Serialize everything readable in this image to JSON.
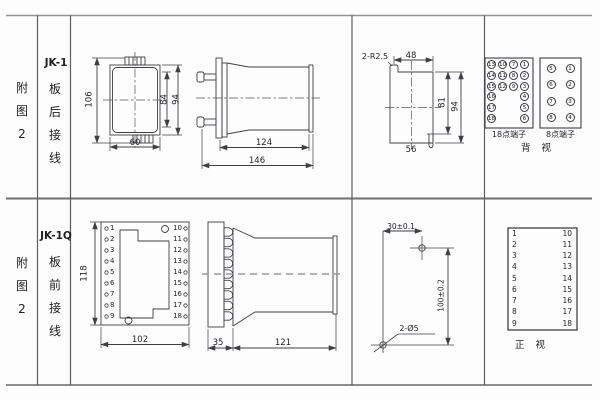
{
  "top": {
    "fig_label": {
      "c1": "附",
      "c2": "图",
      "c3": "2"
    },
    "model": "JK-1",
    "wiring": {
      "c1": "板",
      "c2": "后",
      "c3": "接",
      "c4": "线"
    },
    "rear_dims": {
      "d106": "106",
      "d84": "84",
      "d94": "94",
      "d60": "60"
    },
    "side_dims": {
      "d124": "124",
      "d146": "146"
    },
    "cutout_dims": {
      "radius": "2-R2.5",
      "d48": "48",
      "d81": "81",
      "d94": "94",
      "d56": "56"
    },
    "t18": {
      "label": "18点端子",
      "c1": [
        "13",
        "14",
        "15",
        "16",
        "17",
        "18"
      ],
      "c2": [
        "10",
        "11",
        "12"
      ],
      "c3": [
        "7",
        "8",
        "9"
      ],
      "c4": [
        "1",
        "2",
        "3",
        "4",
        "5",
        "6"
      ]
    },
    "t8": {
      "label": "8点端子",
      "left": [
        "5",
        "6",
        "7",
        "8"
      ],
      "right": [
        "1",
        "2",
        "3",
        "4"
      ]
    },
    "view_label": "背 视"
  },
  "bottom": {
    "fig_label": {
      "c1": "附",
      "c2": "图",
      "c3": "2"
    },
    "model": "JK-1Q",
    "wiring": {
      "c1": "板",
      "c2": "前",
      "c3": "接",
      "c4": "线"
    },
    "front": {
      "left": [
        "1",
        "2",
        "3",
        "4",
        "5",
        "6",
        "7",
        "8",
        "9"
      ],
      "right": [
        "10",
        "11",
        "12",
        "13",
        "14",
        "15",
        "16",
        "17",
        "18"
      ],
      "d118": "118",
      "d102": "102"
    },
    "side_dims": {
      "d35": "35",
      "d121": "121"
    },
    "drill": {
      "dh": "30±0.1",
      "dv": "100±0.2",
      "holes": "2-Ø5"
    },
    "table": {
      "label": "正 视",
      "left": [
        "1",
        "2",
        "3",
        "4",
        "5",
        "6",
        "7",
        "8",
        "9"
      ],
      "right": [
        "10",
        "11",
        "12",
        "13",
        "14",
        "15",
        "16",
        "17",
        "18"
      ]
    }
  }
}
